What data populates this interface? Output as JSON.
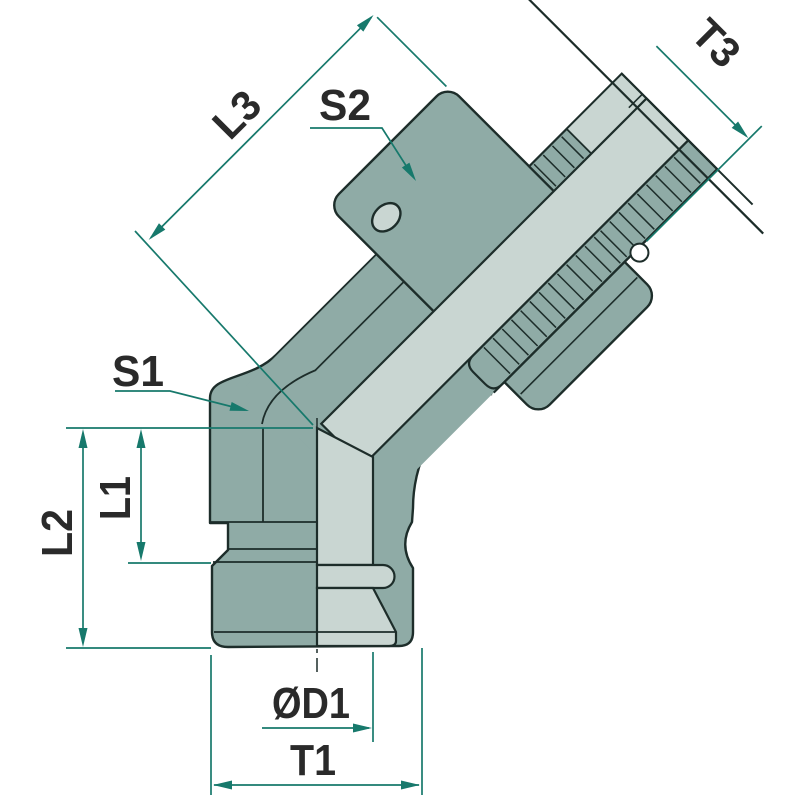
{
  "drawing": {
    "title": "45-degree elbow fitting technical drawing",
    "labels": {
      "l3": "L3",
      "s2": "S2",
      "t3": "T3",
      "s1": "S1",
      "l1": "L1",
      "l2": "L2",
      "d1": "ØD1",
      "t1": "T1"
    },
    "colors": {
      "body_teal": "#8FABA6",
      "section_light": "#C9D6D2",
      "outline_dark": "#1D2D2A",
      "dimension_green": "#17796C",
      "background": "#FFFFFF",
      "label_text": "#2A2A2A"
    }
  }
}
